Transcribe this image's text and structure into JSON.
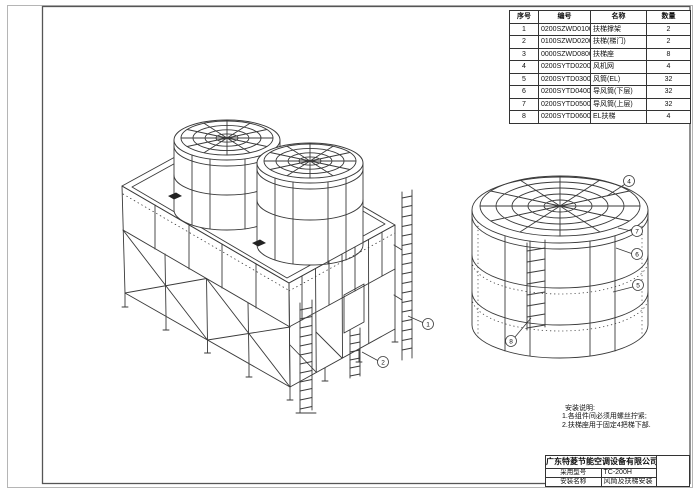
{
  "parts_table": {
    "headers": [
      "序号",
      "编号",
      "名称",
      "数量"
    ],
    "rows": [
      [
        "1",
        "0200SZWD0100",
        "扶梯撑架",
        "2"
      ],
      [
        "2",
        "0100SZWD0200",
        "扶梯(梯门)",
        "2"
      ],
      [
        "3",
        "0000SZWD0800",
        "扶梯座",
        "8"
      ],
      [
        "4",
        "0200SYTD0200",
        "风机网",
        "4"
      ],
      [
        "5",
        "0200SYTD0300",
        "风筒(EL)",
        "32"
      ],
      [
        "6",
        "0200SYTD0400",
        "导风筒(下层)",
        "32"
      ],
      [
        "7",
        "0200SYTD0500",
        "导风筒(上层)",
        "32"
      ],
      [
        "8",
        "0200SYTD0600",
        "EL扶梯",
        "4"
      ]
    ]
  },
  "notes": {
    "title": "安装说明:",
    "line1": "1.各组件间必须用螺丝拧紧;",
    "line2": "2.扶梯座用于固定4把梯下部."
  },
  "title_block": {
    "company": "广东特菱节能空调设备有限公司",
    "model_label": "采用型号",
    "model_value": "TC-200H",
    "install_label": "安装名称",
    "install_value": "风筒及扶梯安装"
  },
  "callouts": {
    "main": [
      "1",
      "2"
    ],
    "detail": [
      "4",
      "7",
      "6",
      "5",
      "8"
    ]
  },
  "colors": {
    "line": "#3a3a3a",
    "page_border": "#b5b5b5",
    "frame": "#555555"
  }
}
